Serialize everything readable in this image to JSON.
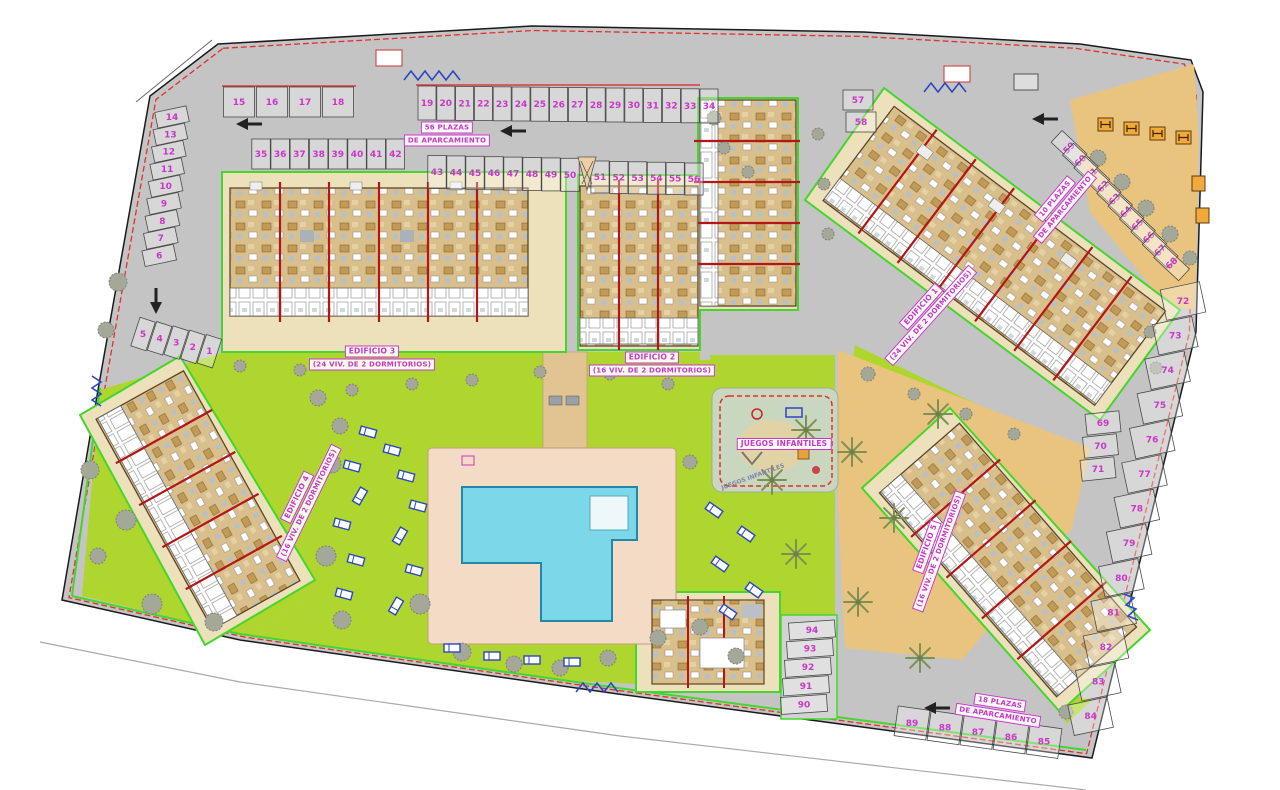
{
  "buildings": [
    {
      "id": "edificio-1",
      "name": "EDIFICIO 1",
      "units": "(24 VIV. DE 2 DORMITORIOS)"
    },
    {
      "id": "edificio-2",
      "name": "EDIFICIO 2",
      "units": "(16 VIV. DE 2 DORMITORIOS)"
    },
    {
      "id": "edificio-3",
      "name": "EDIFICIO 3",
      "units": "(24 VIV. DE 2 DORMITORIOS)"
    },
    {
      "id": "edificio-4",
      "name": "EDIFICIO 4",
      "units": "(16 VIV. DE 2 DORMITORIOS)"
    },
    {
      "id": "edificio-5",
      "name": "EDIFICIO 5",
      "units": "(16 VIV. DE 2 DORMITORIOS)"
    }
  ],
  "area_labels": {
    "playground": "JUEGOS INFANTILES",
    "playground_ground": "JUEGOS INFANTILES",
    "parking_top_1": "56 PLAZAS",
    "parking_top_2": "DE APARCAMIENTO",
    "parking_right_1": "10 PLAZAS",
    "parking_right_2": "DE APARCAMIENTO",
    "parking_bottom_1": "18 PLAZAS",
    "parking_bottom_2": "DE APARCAMIENTO"
  },
  "parking_groups": [
    {
      "id": "row-1-5",
      "numbers": [
        "5",
        "4",
        "3",
        "2",
        "1"
      ]
    },
    {
      "id": "col-6-14",
      "numbers": [
        "14",
        "13",
        "12",
        "11",
        "10",
        "9",
        "8",
        "7",
        "6"
      ]
    },
    {
      "id": "row-15-18",
      "numbers": [
        "15",
        "16",
        "17",
        "18"
      ]
    },
    {
      "id": "row-19-34",
      "numbers": [
        "19",
        "20",
        "21",
        "22",
        "23",
        "24",
        "25",
        "26",
        "27",
        "28",
        "29",
        "30",
        "31",
        "32",
        "33",
        "34"
      ]
    },
    {
      "id": "row-35-42",
      "numbers": [
        "35",
        "36",
        "37",
        "38",
        "39",
        "40",
        "41",
        "42"
      ]
    },
    {
      "id": "row-43-50",
      "numbers": [
        "43",
        "44",
        "45",
        "46",
        "47",
        "48",
        "49",
        "50"
      ]
    },
    {
      "id": "row-51-56",
      "numbers": [
        "51",
        "52",
        "53",
        "54",
        "55",
        "56"
      ]
    },
    {
      "id": "pair-57-58",
      "numbers": [
        "57",
        "58"
      ]
    },
    {
      "id": "diag-59-68",
      "numbers": [
        "59",
        "60",
        "61",
        "62",
        "63",
        "64",
        "65",
        "66",
        "67",
        "68"
      ]
    },
    {
      "id": "col-69-71",
      "numbers": [
        "69",
        "70",
        "71"
      ]
    },
    {
      "id": "edge-72-84",
      "numbers": [
        "72",
        "73",
        "74",
        "75",
        "76",
        "77",
        "78",
        "79",
        "80",
        "81",
        "82",
        "83",
        "84"
      ]
    },
    {
      "id": "row-85-89",
      "numbers": [
        "89",
        "88",
        "87",
        "86",
        "85"
      ]
    },
    {
      "id": "stack-90-94",
      "numbers": [
        "94",
        "93",
        "92",
        "91",
        "90"
      ]
    }
  ],
  "colors": {
    "lawn": "#aed62f",
    "parking": "#c4c4c4",
    "building": "#d9bf8b",
    "pool": "#7cd8e8",
    "deck": "#f3dbc5",
    "sand": "#e9c47e",
    "plot": "#ece1ba",
    "label": "#c837c8",
    "boundary_red": "#e03028",
    "line_green": "#44d62c",
    "blue": "#2b46c0"
  }
}
